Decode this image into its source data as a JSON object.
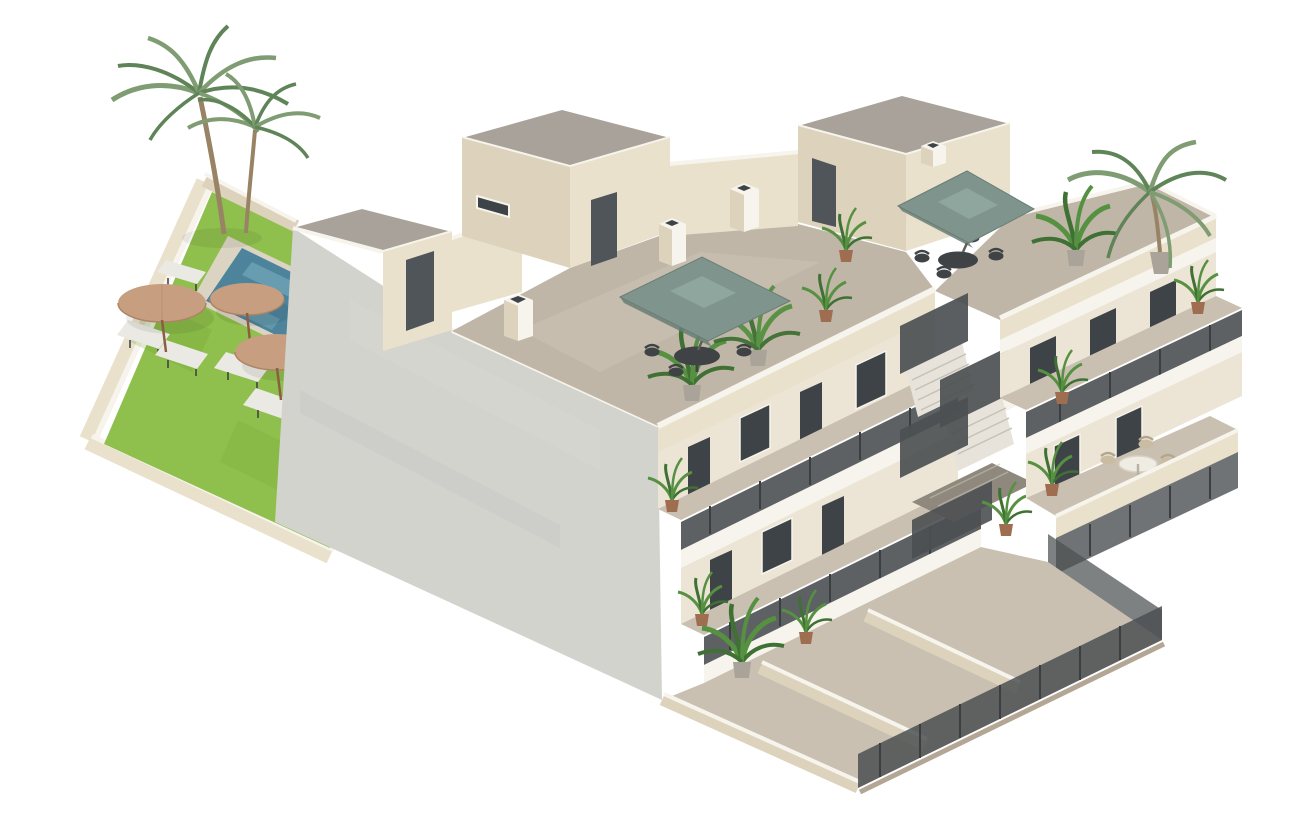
{
  "meta": {
    "title": "Isometric 3D render — new-build apartment block with communal pool garden",
    "type": "architectural-visualization",
    "background_note": "white studio background"
  },
  "colors": {
    "bg": "#ffffff",
    "facade_gray": "#d3d3ce",
    "facade_gray_dark": "#c4c4bf",
    "wall_cream": "#e9e1cb",
    "wall_cream_shade": "#ddd3bd",
    "wall_white": "#f6f4ec",
    "corridor_wall": "#ece5d6",
    "roof_gray": "#a9a29a",
    "deck_taupe": "#c0b6a7",
    "deck_taupe_light": "#d0c7b8",
    "floor_beige": "#c9c0b1",
    "lawn_green": "#8fbf4c",
    "lawn_green_dark": "#6fa032",
    "pool_blue": "#4d849b",
    "pool_blue_light": "#7fb3c2",
    "stone_pale": "#dbd4c3",
    "umbrella_tan": "#c79e80",
    "umbrella_tan_dark": "#ad8464",
    "umbrella_sage": "#7e948c",
    "umbrella_sage_light": "#8ea69d",
    "umbrella_sage_dark": "#687e76",
    "metal_dark": "#4c5052",
    "metal_post": "#3b3f41",
    "door_dark": "#50555a",
    "glass_dark": "#3e4347",
    "plant_green": "#559140",
    "plant_green_dark": "#3f7034",
    "palm_green": "#7f9c72",
    "palm_green_dark": "#5f8458",
    "trunk_brown": "#988465",
    "pot_terracotta": "#9f6e50",
    "pot_gray": "#a9a399",
    "furniture_dark": "#3f4345",
    "furniture_tan": "#c9bca3",
    "curb_taupe": "#b3a695",
    "stair_void": "#8e887d",
    "step_light": "#e7e3da",
    "step_edge": "#c6c1b6",
    "pole_gray": "#5f5f5a",
    "lounger_white": "#ebe9e4"
  },
  "scene": {
    "garden": {
      "label": "communal pool garden",
      "features": [
        "artificial lawn",
        "swimming pool",
        "stone pool deck",
        "cream perimeter walls"
      ],
      "palm_trees": 2,
      "wicker_parasols": 3,
      "sun_loungers": 5
    },
    "building": {
      "label": "three-storey apartment block, isometric cutaway",
      "storeys": [
        "ground-floor patios",
        "first-floor walkway",
        "second-floor walkway",
        "roof terraces"
      ],
      "roof": {
        "penthouse_stair_rooms": 3,
        "chimneys": 4,
        "square_sage_parasols": 2,
        "dining_sets": 2,
        "parapet_walls": "cream with white caps"
      },
      "circulation": [
        "external concrete staircase",
        "dark perforated-metal railings"
      ],
      "right_wing": {
        "stacked_balconies": 2,
        "terrace_dining_set": "round white table with four wicker chairs",
        "ground_fences": "dark metal panels",
        "corner_palm": 1
      },
      "potted_plants": 13
    }
  }
}
